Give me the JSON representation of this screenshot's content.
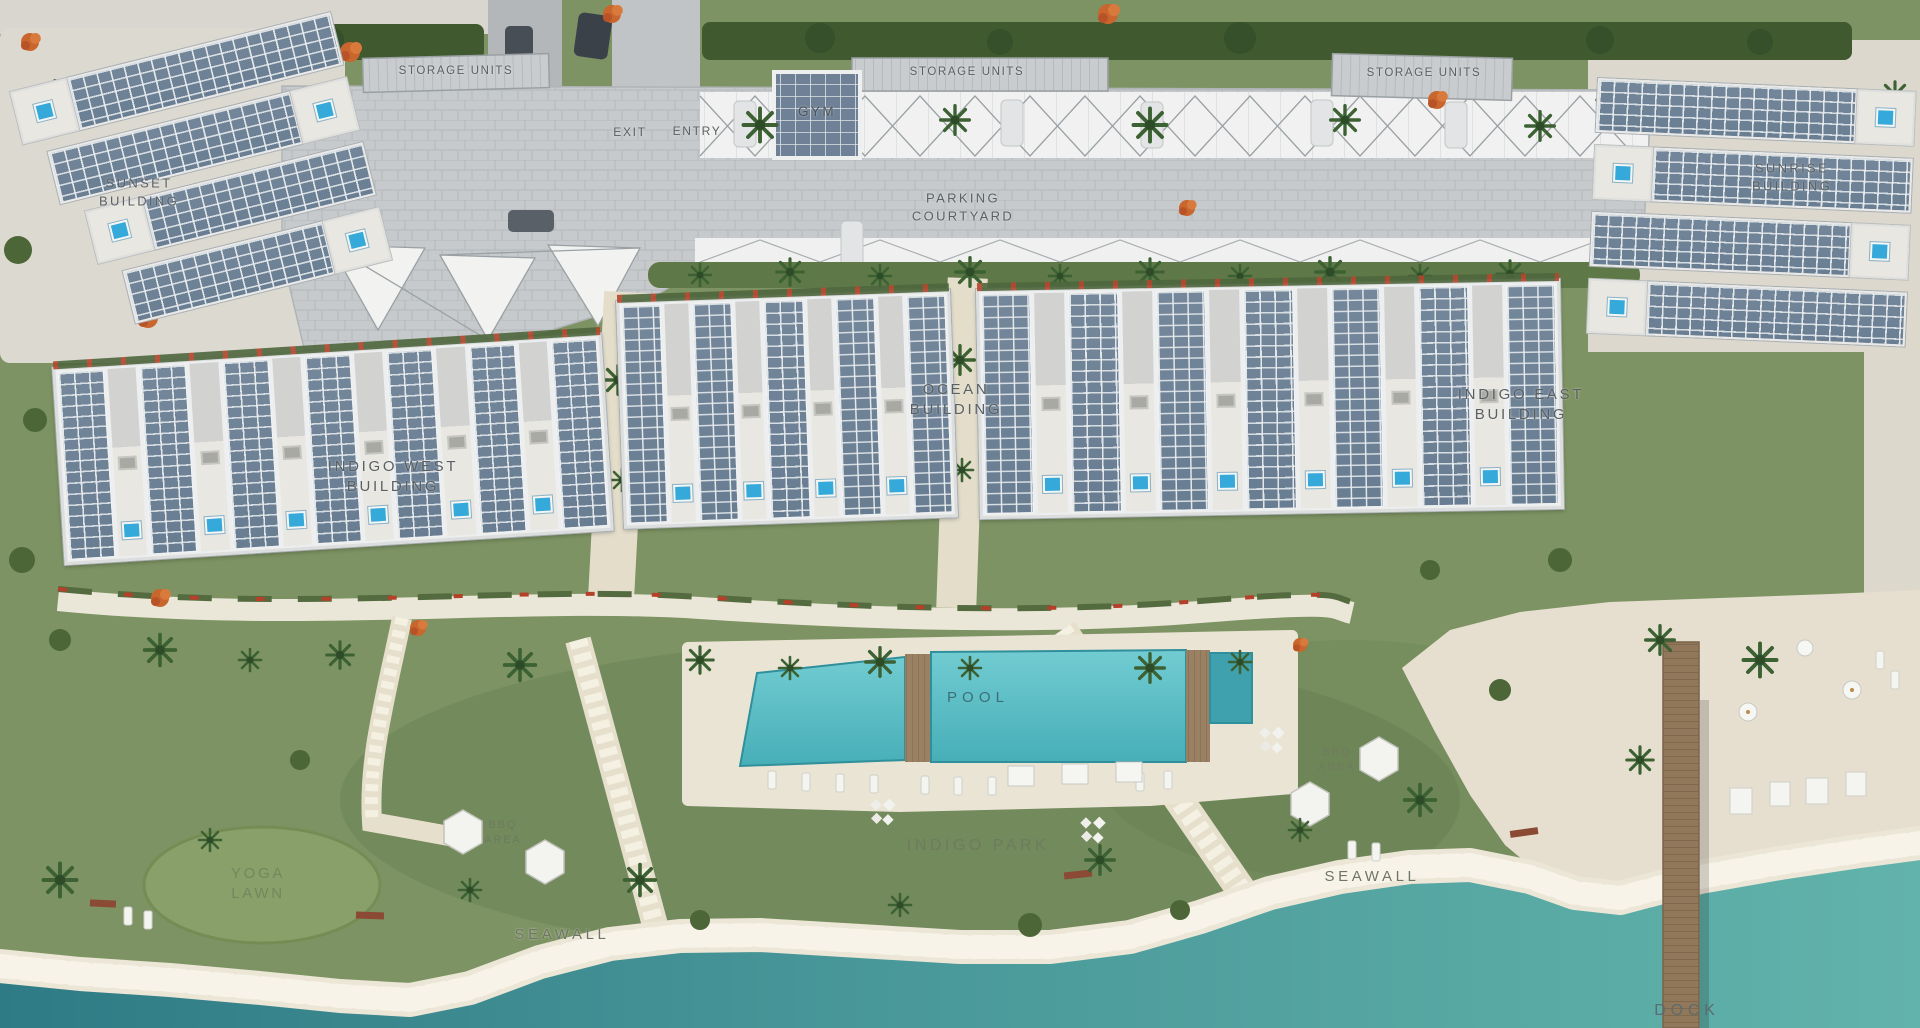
{
  "labels": {
    "storage_units_1": "STORAGE UNITS",
    "storage_units_2": "STORAGE UNITS",
    "storage_units_3": "STORAGE UNITS",
    "exit": "EXIT",
    "entry": "ENTRY",
    "gym": "GYM",
    "parking_courtyard": "PARKING COURTYARD",
    "sunset_building": "SUNSET BUILDING",
    "sunrise_building": "SUNRISE BUILDING",
    "indigo_west_building": "INDIGO WEST BUILDING",
    "ocean_building": "OCEAN BUILDING",
    "indigo_east_building": "INDIGO EAST BUILDING",
    "pool": "POOL",
    "bbq_area_west": "BBQ AREA",
    "bbq_area_east": "BBQ AREA",
    "indigo_park": "INDIGO PARK",
    "yoga_lawn": "YOGA LAWN",
    "seawall_west": "SEAWALL",
    "seawall_east": "SEAWALL",
    "dock": "DOCK"
  },
  "colors": {
    "lawn": "#7d9363",
    "dense_vegetation": "#41592f",
    "water_dark": "#2f7b85",
    "water_light": "#62b3ab",
    "pool_water": "#4fb4bc",
    "plunge_pool": "#35aada",
    "sand_beach": "#e6dfcf",
    "seawall_rock": "#ece6d7",
    "pavement": "#c6cacc",
    "canopy_white": "#f0f1f0",
    "roof_panel_blue": "#6f8296",
    "building_white": "#eceeef",
    "dock_wood": "#91785a",
    "accent_orange": "#c9662e",
    "label_gray": "#5a5f62"
  }
}
